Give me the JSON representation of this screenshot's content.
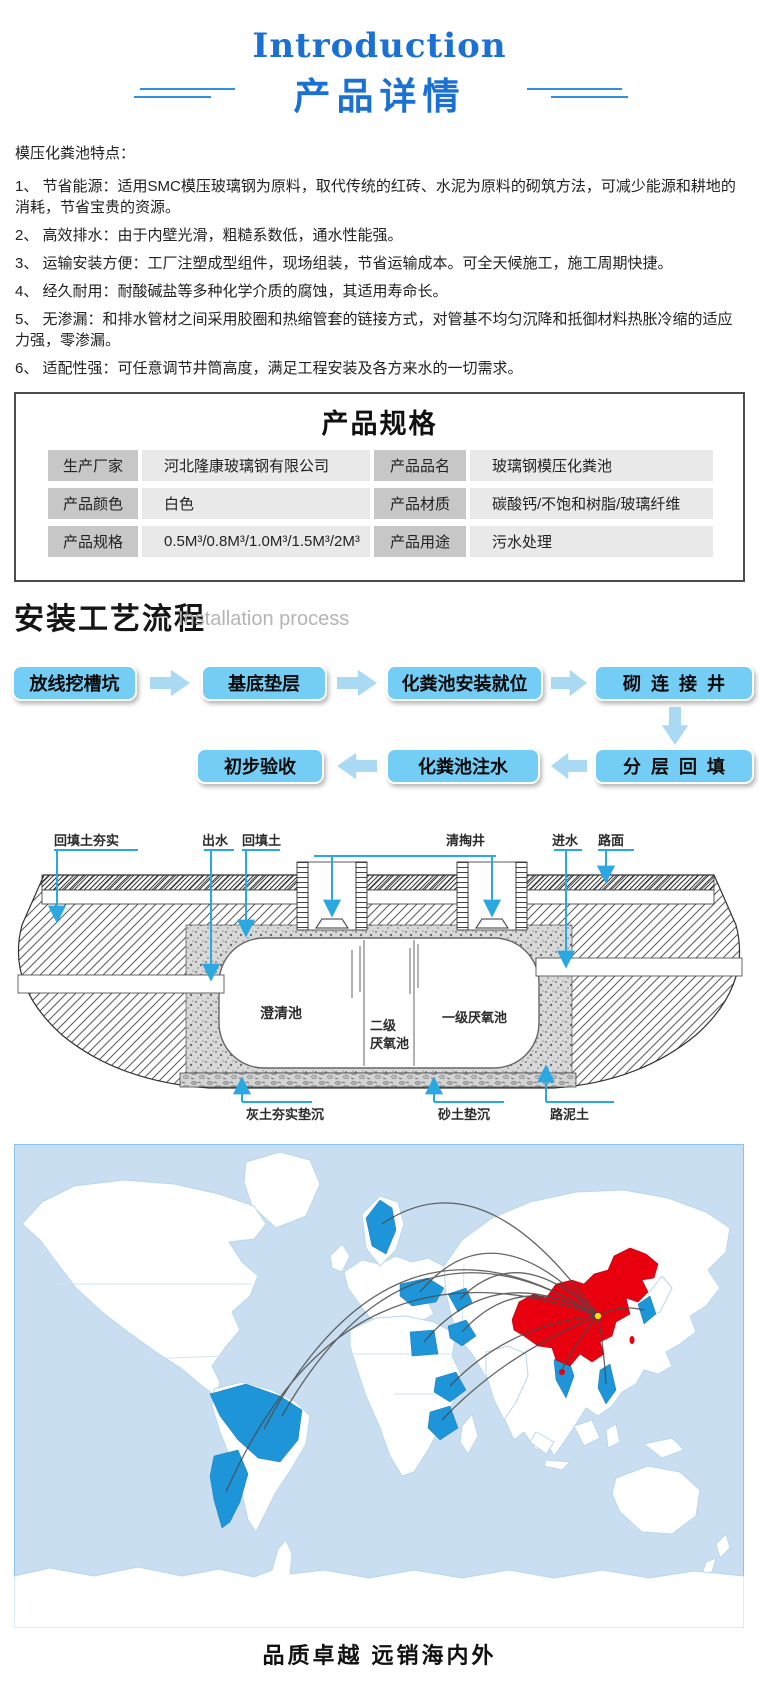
{
  "header": {
    "title_en": "Introduction",
    "title_zh": "产品详情"
  },
  "features": {
    "heading": "模压化粪池特点：",
    "items": [
      "1、 节省能源：适用SMC模压玻璃钢为原料，取代传统的红砖、水泥为原料的砌筑方法，可减少能源和耕地的消耗，节省宝贵的资源。",
      "2、 高效排水：由于内壁光滑，粗糙系数低，通水性能强。",
      "3、 运输安装方便：工厂注塑成型组件，现场组装，节省运输成本。可全天候施工，施工周期快捷。",
      "4、 经久耐用：耐酸碱盐等多种化学介质的腐蚀，其适用寿命长。",
      "5、 无渗漏：和排水管材之间采用胶圈和热缩管套的链接方式，对管基不均匀沉降和抵御材料热胀冷缩的适应力强，零渗漏。",
      "6、 适配性强：可任意调节井筒高度，满足工程安装及各方来水的一切需求。"
    ]
  },
  "specs": {
    "title": "产品规格",
    "cells": [
      {
        "label": "生产厂家",
        "value": "河北隆康玻璃钢有限公司"
      },
      {
        "label": "产品品名",
        "value": "玻璃钢模压化粪池"
      },
      {
        "label": "产品颜色",
        "value": "白色"
      },
      {
        "label": "产品材质",
        "value": "碳酸钙/不饱和树脂/玻璃纤维"
      },
      {
        "label": "产品规格",
        "value": "0.5M³/0.8M³/1.0M³/1.5M³/2M³"
      },
      {
        "label": "产品用途",
        "value": "污水处理"
      }
    ]
  },
  "process": {
    "title_zh": "安装工艺流程",
    "title_en": "Installation process",
    "row1": [
      "放线挖槽坑",
      "基底垫层",
      "化粪池安装就位",
      "砌  连  接  井"
    ],
    "row2": [
      "初步验收",
      "化粪池注水",
      "分  层  回  填"
    ]
  },
  "diagram": {
    "top_labels": [
      "回填土夯实",
      "出水",
      "回填土",
      "清掏井",
      "进水",
      "路面"
    ],
    "chamber_labels": [
      "澄清池",
      "二级",
      "厌氧池",
      "一级厌氧池"
    ],
    "bottom_labels": [
      "灰土夯实垫沉",
      "砂土垫沉",
      "路泥土"
    ]
  },
  "footer": {
    "slogan": "品质卓越  远销海内外"
  },
  "colors": {
    "accent_blue": "#1b71d3",
    "flow_box": "#74cdf4",
    "flow_arrow": "#a9d9f3",
    "leader_blue": "#29a8e2",
    "map_ocean": "#c9dff1",
    "map_border": "#8cc3e8",
    "map_highlight_blue": "#1e95d8",
    "map_china_red": "#e8000f",
    "route_line": "#4a4a4a",
    "origin_marker_yellow": "#ffdf00"
  }
}
